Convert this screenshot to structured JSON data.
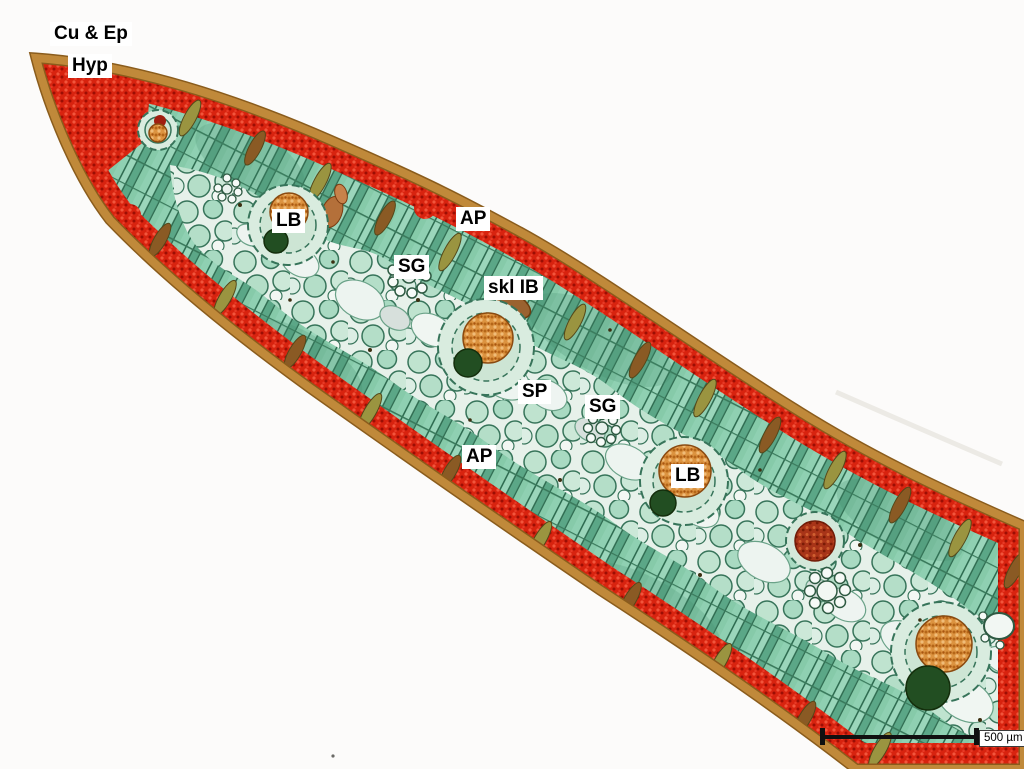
{
  "annotations": {
    "items": [
      {
        "text": "Cu & Ep"
      },
      {
        "text": "Hyp"
      },
      {
        "text": "LB"
      },
      {
        "text": "AP"
      },
      {
        "text": "SG"
      },
      {
        "text": "skl IB"
      },
      {
        "text": "SP"
      },
      {
        "text": "SG"
      },
      {
        "text": "AP"
      },
      {
        "text": "LB"
      }
    ]
  },
  "scale_bar": {
    "label": "500 µm"
  },
  "palette": {
    "background": "#fcfbfa",
    "cuticle": "#c0893a",
    "cuticle_edge": "#8a5c1c",
    "hypodermis_red": "#d8230f",
    "palisade_green": "#7cc2a1",
    "spongy_pale": "#e7f1ea",
    "bundle_orange": "#dc9340",
    "bundle_dark_green": "#224e22",
    "streak_olive": "#9a9440",
    "streak_brown": "#8a5a24",
    "scale_bar_color": "#101010"
  }
}
